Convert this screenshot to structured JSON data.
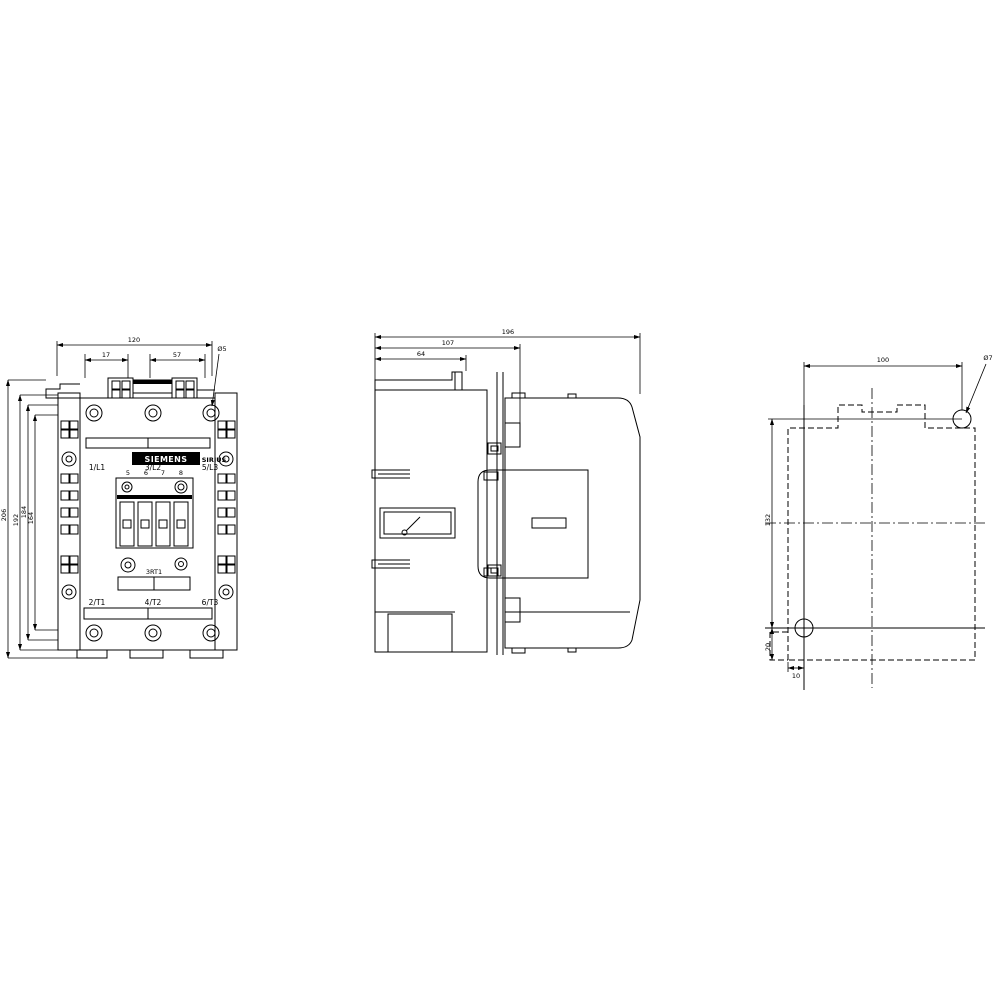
{
  "drawing": {
    "background_color": "#ffffff",
    "line_color": "#000000",
    "views": {
      "front": {
        "brand_label": "SIEMENS",
        "series_label": "SIRIUS",
        "model_label": "3RT1",
        "terminals_top": [
          "1/L1",
          "3/L2",
          "5/L3"
        ],
        "terminals_bottom": [
          "2/T1",
          "4/T2",
          "6/T3"
        ],
        "aux_terminal_numbers": [
          "5",
          "6",
          "7",
          "8"
        ],
        "dims": {
          "overall_width": "120",
          "hole_offset_left": "17",
          "hole_spacing_right": "57",
          "hole_diameter": "Ø5",
          "height_outer": "206",
          "height_2": "192",
          "height_3": "184",
          "height_inner": "164"
        }
      },
      "side": {
        "dims": {
          "depth_total": "196",
          "depth_mid": "107",
          "depth_front": "64"
        }
      },
      "rear": {
        "dims": {
          "hole_spacing_h": "100",
          "hole_spacing_v": "132",
          "hole_offset_bottom": "20",
          "hole_offset_left": "10",
          "hole_diameter": "Ø7"
        }
      }
    }
  }
}
